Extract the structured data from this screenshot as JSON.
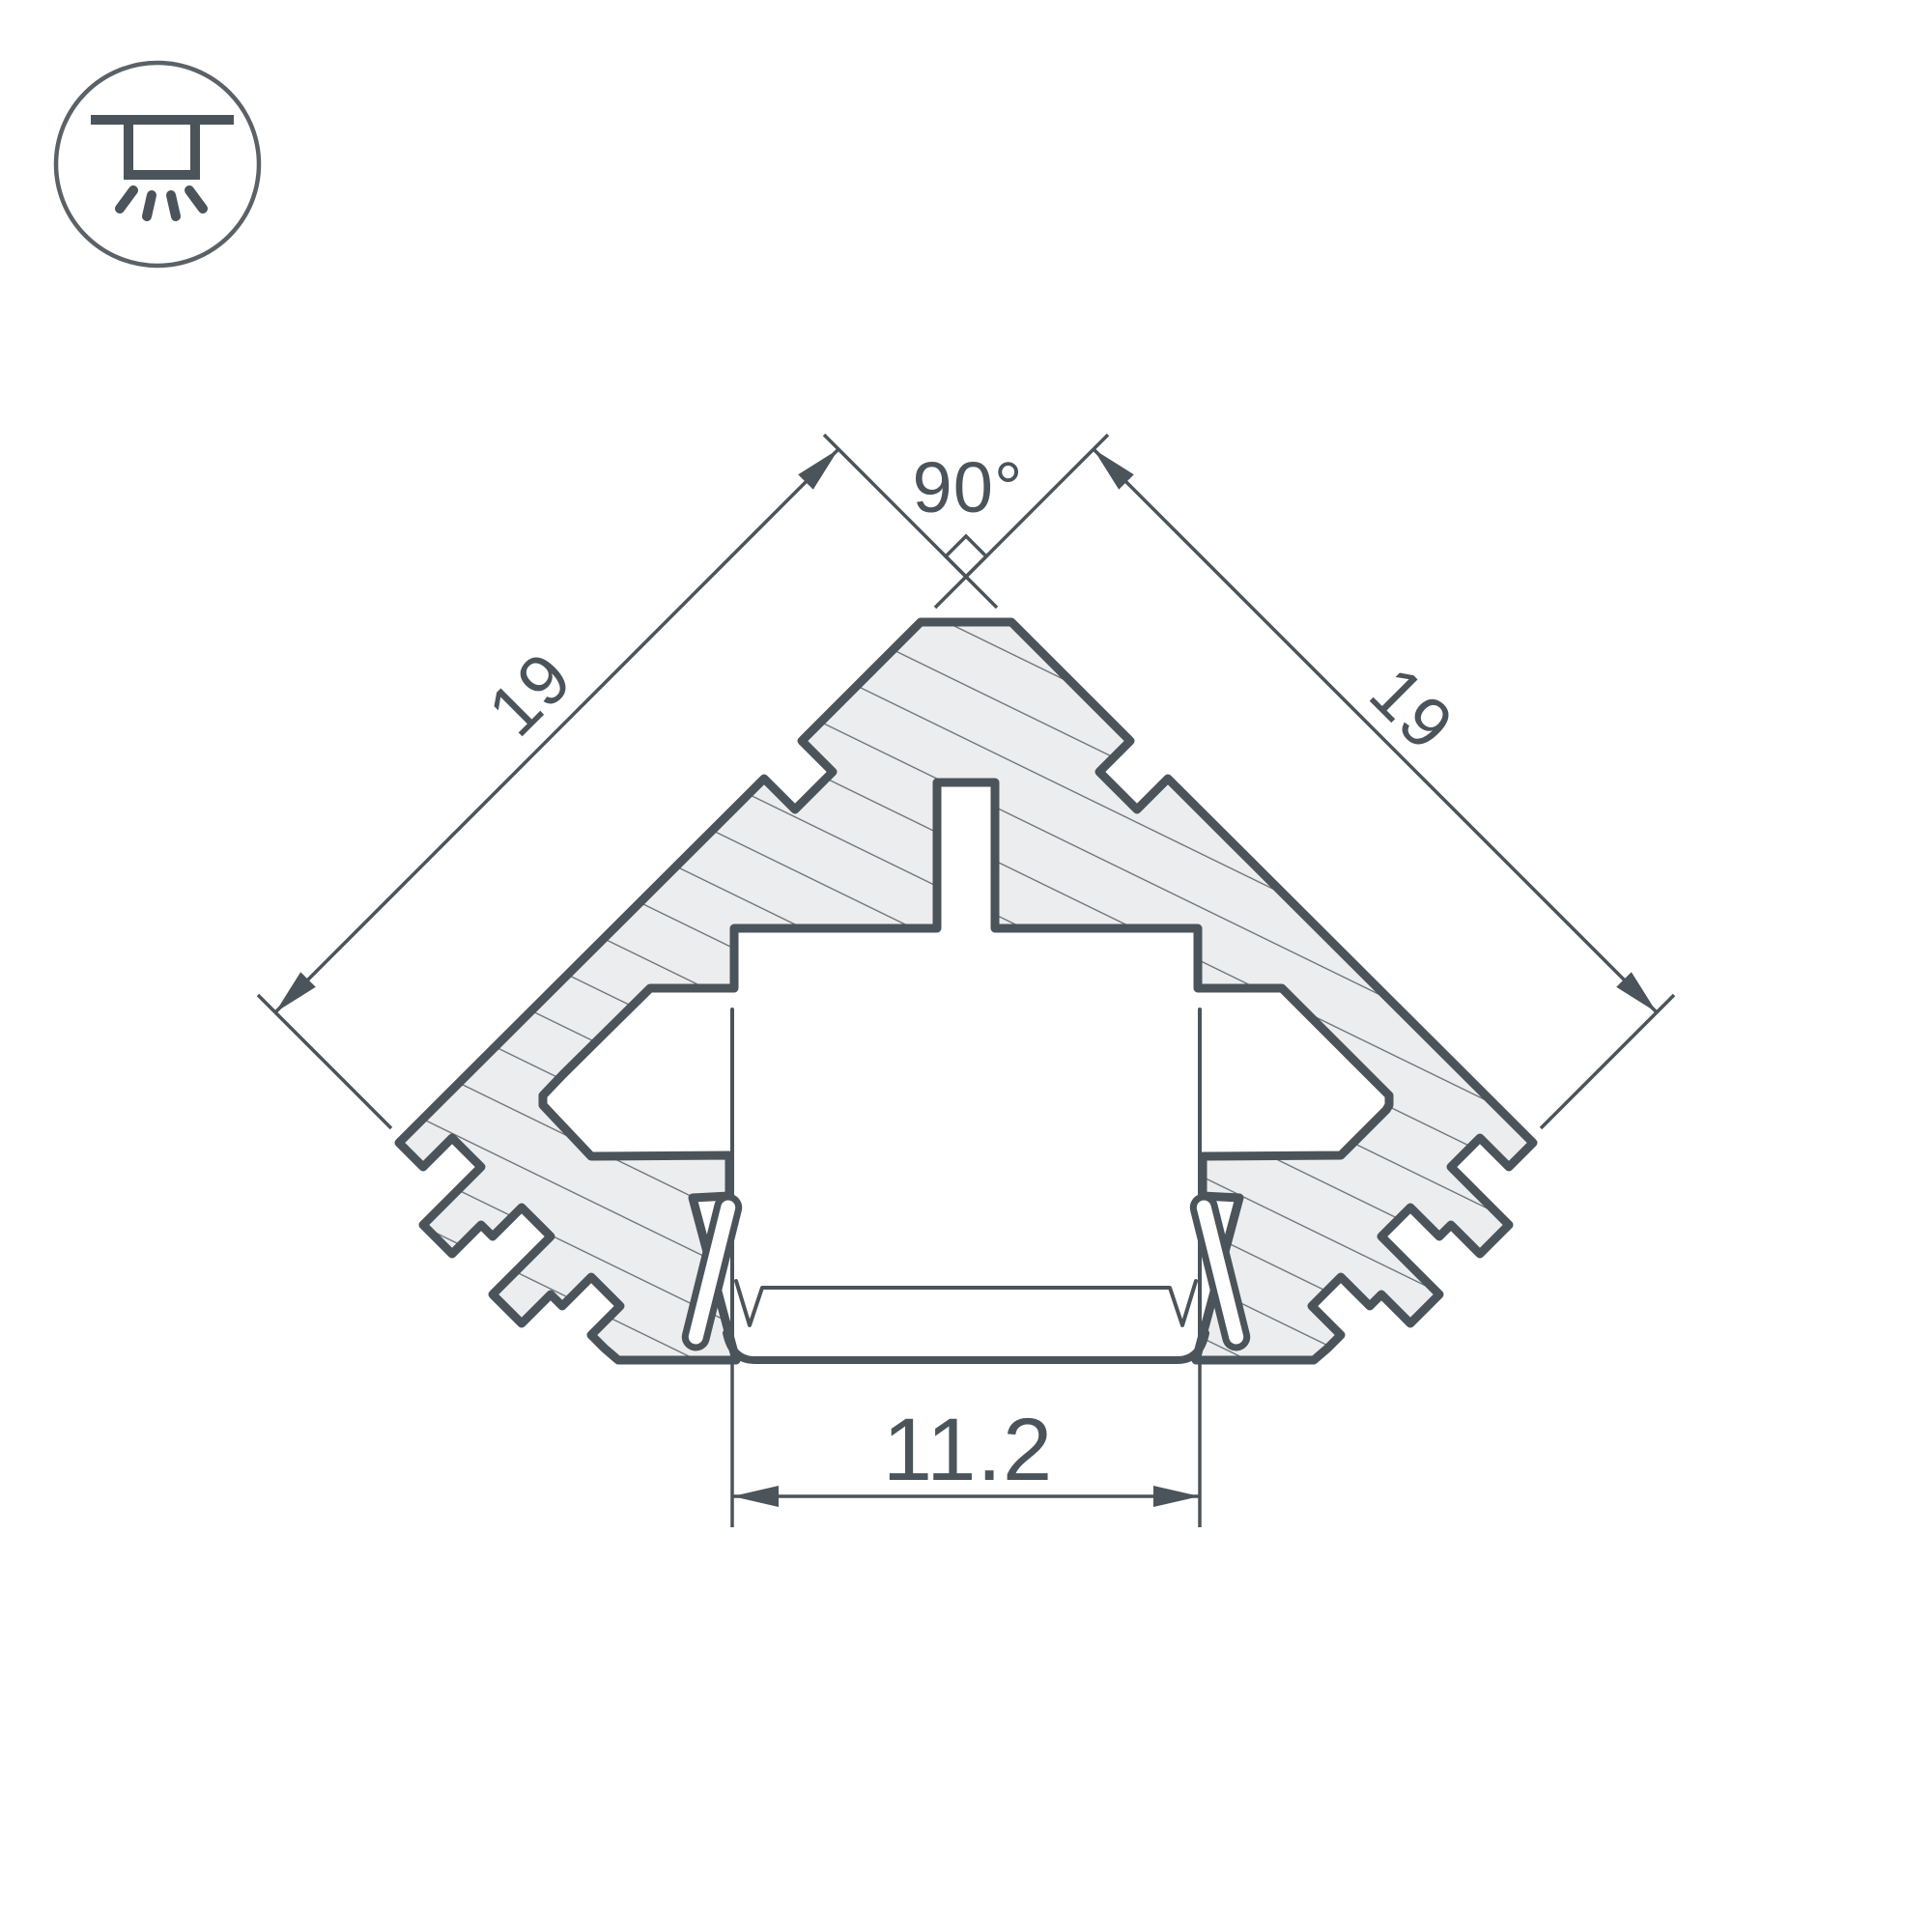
{
  "drawing": {
    "kind": "led-profile-cross-section",
    "colors": {
      "line": "#4b545a",
      "hatch_line": "#666d73",
      "metal_fill": "#ecedee",
      "background": "#ffffff"
    },
    "mount_icon": "recessed-ceiling-light",
    "dimensions": {
      "left_side_length": "19",
      "right_side_length": "19",
      "apex_angle": "90°",
      "window_width": "11.2"
    }
  }
}
